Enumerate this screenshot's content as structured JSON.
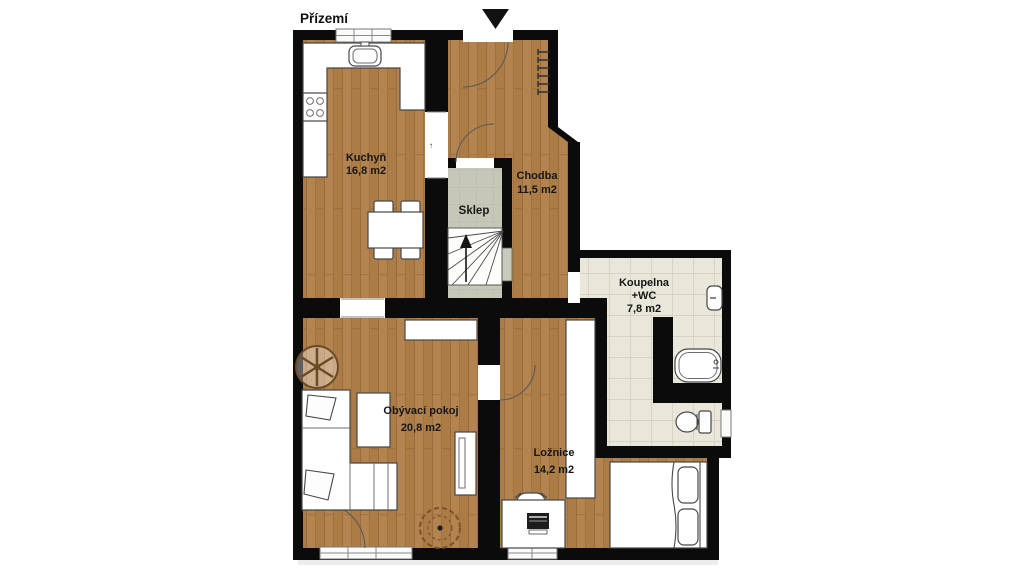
{
  "title": "Přízemí",
  "rooms": {
    "kuchyn": {
      "name": "Kuchyň",
      "area": "16,8 m2"
    },
    "chodba": {
      "name": "Chodba",
      "area": "11,5 m2"
    },
    "sklep": {
      "name": "Sklep"
    },
    "koupelna": {
      "name": "Koupelna",
      "subname": "+WC",
      "area": "7,8 m2"
    },
    "obyvaci_pokoj": {
      "name": "Obývací pokoj",
      "area": "20,8 m2"
    },
    "loznice": {
      "name": "Ložnice",
      "area": "14,2 m2"
    }
  },
  "markers": {
    "kitchen_door": "↑"
  },
  "colors": {
    "wall": "#0b0b0b",
    "wood_floor": "#ac7c47",
    "bathroom_tile": "#e9e6da",
    "cellar_tile": "#c6c7b7",
    "furniture_outline": "#474747",
    "background": "#ffffff"
  }
}
